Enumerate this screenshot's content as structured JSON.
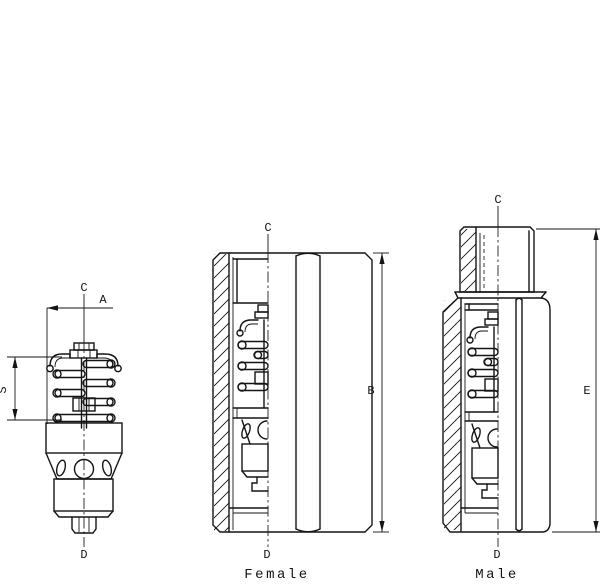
{
  "figures": {
    "insert": {
      "labels": {
        "axis_top": "C",
        "width": "A",
        "spring_height": "S",
        "axis_bottom": "D"
      }
    },
    "female": {
      "caption": "Female",
      "labels": {
        "axis_top": "C",
        "height": "B",
        "axis_bottom": "D"
      }
    },
    "male": {
      "caption": "Male",
      "labels": {
        "axis_top": "C",
        "height": "E",
        "axis_bottom": "D"
      }
    }
  },
  "colors": {
    "ink": "#141414",
    "paper": "#ffffff"
  }
}
